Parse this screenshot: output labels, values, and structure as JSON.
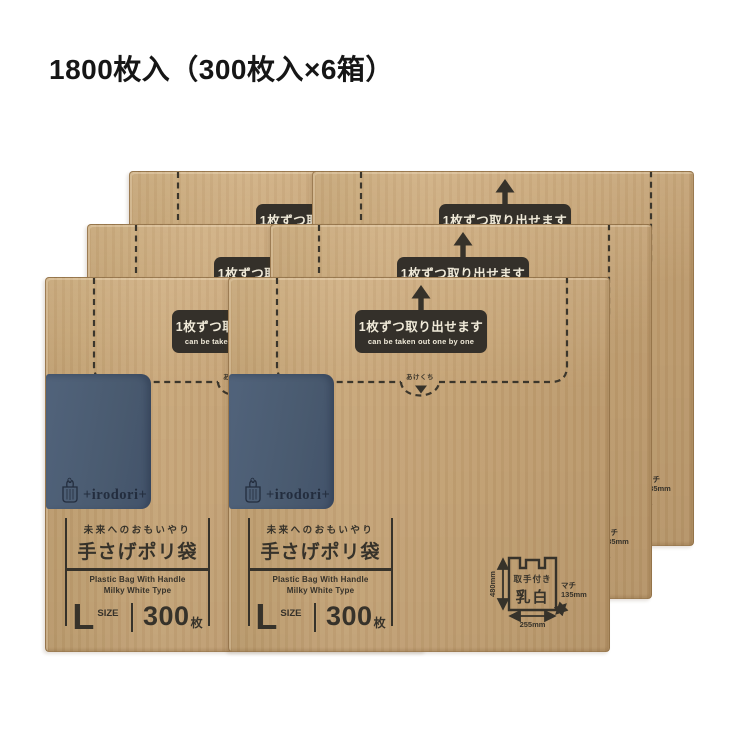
{
  "header": {
    "quantity_note": "1800枚入（300枚入×6箱）"
  },
  "box": {
    "takeout_jp": "1枚ずつ取り出せます",
    "takeout_en": "can be taken out one by one",
    "opening_label": "あけくち",
    "brand_name": "+irodori+",
    "tagline": "未来へのおもいやり",
    "product_name": "手さげポリ袋",
    "subtitle_en1": "Plastic Bag With Handle",
    "subtitle_en2": "Milky White Type",
    "size_letter": "L",
    "size_word": "SIZE",
    "sheet_count": "300",
    "sheet_unit": "枚",
    "spec": {
      "handle": "取手付き",
      "color": "乳白",
      "height": "480mm",
      "width": "255mm",
      "gusset_label": "マチ",
      "gusset_value": "135mm"
    }
  },
  "colors": {
    "kraft": "#c6a376",
    "ink": "#36322a",
    "badge_bg": "#34302a",
    "badge_text": "#f0ead9",
    "patch_blue": "#4c5e73",
    "logo_navy": "#232d3e",
    "background": "#ffffff"
  }
}
